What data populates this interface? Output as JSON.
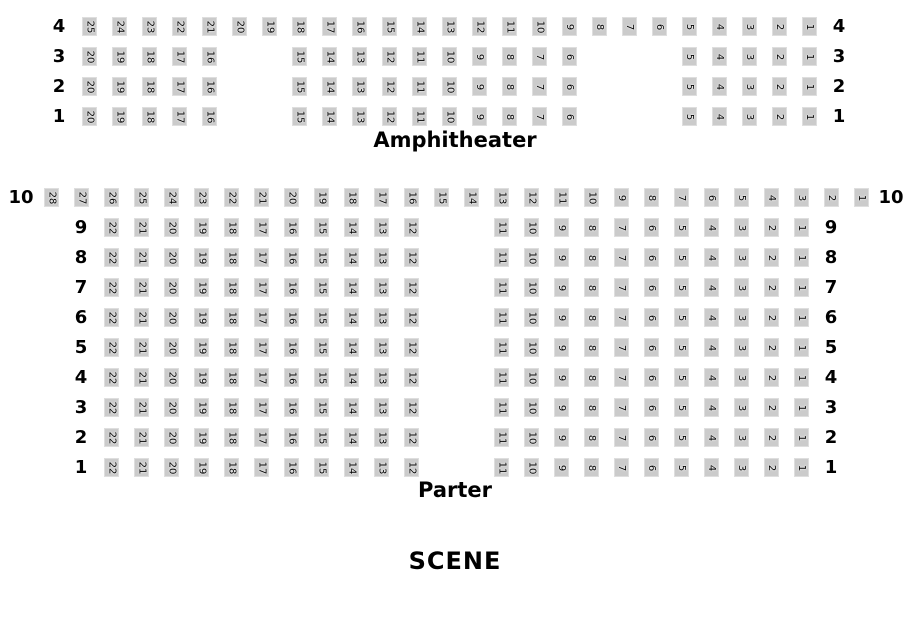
{
  "colors": {
    "background": "#ffffff",
    "seat_bg": "#cbcbcb",
    "seat_edge": "#dedede",
    "text": "#000000"
  },
  "amphitheater": {
    "title": "Amphitheater",
    "rows": [
      {
        "label": "4",
        "cells": [
          "L",
          "25",
          "24",
          "23",
          "22",
          "21",
          "20",
          "19",
          "18",
          "17",
          "16",
          "15",
          "14",
          "13",
          "12",
          "11",
          "10",
          "9",
          "8",
          "7",
          "6",
          "5",
          "4",
          "3",
          "2",
          "1",
          "L"
        ]
      },
      {
        "label": "3",
        "cells": [
          "L",
          "20",
          "19",
          "18",
          "17",
          "16",
          "",
          "",
          "15",
          "14",
          "13",
          "12",
          "11",
          "10",
          "9",
          "8",
          "7",
          "6",
          "",
          "",
          "",
          "5",
          "4",
          "3",
          "2",
          "1",
          "L"
        ]
      },
      {
        "label": "2",
        "cells": [
          "L",
          "20",
          "19",
          "18",
          "17",
          "16",
          "",
          "",
          "15",
          "14",
          "13",
          "12",
          "11",
          "10",
          "9",
          "8",
          "7",
          "6",
          "",
          "",
          "",
          "5",
          "4",
          "3",
          "2",
          "1",
          "L"
        ]
      },
      {
        "label": "1",
        "cells": [
          "L",
          "20",
          "19",
          "18",
          "17",
          "16",
          "",
          "",
          "15",
          "14",
          "13",
          "12",
          "11",
          "10",
          "9",
          "8",
          "7",
          "6",
          "",
          "",
          "",
          "5",
          "4",
          "3",
          "2",
          "1",
          "L"
        ]
      }
    ]
  },
  "parter": {
    "title": "Parter",
    "rows": [
      {
        "label": "10",
        "cells": [
          "L",
          "28",
          "27",
          "26",
          "25",
          "24",
          "23",
          "22",
          "21",
          "20",
          "19",
          "18",
          "17",
          "16",
          "15",
          "14",
          "13",
          "12",
          "11",
          "10",
          "9",
          "8",
          "7",
          "6",
          "5",
          "4",
          "3",
          "2",
          "1",
          "L"
        ]
      },
      {
        "label": "9",
        "cells": [
          "",
          "",
          "L",
          "22",
          "21",
          "20",
          "19",
          "18",
          "17",
          "16",
          "15",
          "14",
          "13",
          "12",
          "",
          "",
          "11",
          "10",
          "9",
          "8",
          "7",
          "6",
          "5",
          "4",
          "3",
          "2",
          "1",
          "L",
          "",
          ""
        ]
      },
      {
        "label": "8",
        "cells": [
          "",
          "",
          "L",
          "22",
          "21",
          "20",
          "19",
          "18",
          "17",
          "16",
          "15",
          "14",
          "13",
          "12",
          "",
          "",
          "11",
          "10",
          "9",
          "8",
          "7",
          "6",
          "5",
          "4",
          "3",
          "2",
          "1",
          "L",
          "",
          ""
        ]
      },
      {
        "label": "7",
        "cells": [
          "",
          "",
          "L",
          "22",
          "21",
          "20",
          "19",
          "18",
          "17",
          "16",
          "15",
          "14",
          "13",
          "12",
          "",
          "",
          "11",
          "10",
          "9",
          "8",
          "7",
          "6",
          "5",
          "4",
          "3",
          "2",
          "1",
          "L",
          "",
          ""
        ]
      },
      {
        "label": "6",
        "cells": [
          "",
          "",
          "L",
          "22",
          "21",
          "20",
          "19",
          "18",
          "17",
          "16",
          "15",
          "14",
          "13",
          "12",
          "",
          "",
          "11",
          "10",
          "9",
          "8",
          "7",
          "6",
          "5",
          "4",
          "3",
          "2",
          "1",
          "L",
          "",
          ""
        ]
      },
      {
        "label": "5",
        "cells": [
          "",
          "",
          "L",
          "22",
          "21",
          "20",
          "19",
          "18",
          "17",
          "16",
          "15",
          "14",
          "13",
          "12",
          "",
          "",
          "11",
          "10",
          "9",
          "8",
          "7",
          "6",
          "5",
          "4",
          "3",
          "2",
          "1",
          "L",
          "",
          ""
        ]
      },
      {
        "label": "4",
        "cells": [
          "",
          "",
          "L",
          "22",
          "21",
          "20",
          "19",
          "18",
          "17",
          "16",
          "15",
          "14",
          "13",
          "12",
          "",
          "",
          "11",
          "10",
          "9",
          "8",
          "7",
          "6",
          "5",
          "4",
          "3",
          "2",
          "1",
          "L",
          "",
          ""
        ]
      },
      {
        "label": "3",
        "cells": [
          "",
          "",
          "L",
          "22",
          "21",
          "20",
          "19",
          "18",
          "17",
          "16",
          "15",
          "14",
          "13",
          "12",
          "",
          "",
          "11",
          "10",
          "9",
          "8",
          "7",
          "6",
          "5",
          "4",
          "3",
          "2",
          "1",
          "L",
          "",
          ""
        ]
      },
      {
        "label": "2",
        "cells": [
          "",
          "",
          "L",
          "22",
          "21",
          "20",
          "19",
          "18",
          "17",
          "16",
          "15",
          "14",
          "13",
          "12",
          "",
          "",
          "11",
          "10",
          "9",
          "8",
          "7",
          "6",
          "5",
          "4",
          "3",
          "2",
          "1",
          "L",
          "",
          ""
        ]
      },
      {
        "label": "1",
        "cells": [
          "",
          "",
          "L",
          "22",
          "21",
          "20",
          "19",
          "18",
          "17",
          "16",
          "15",
          "14",
          "13",
          "12",
          "",
          "",
          "11",
          "10",
          "9",
          "8",
          "7",
          "6",
          "5",
          "4",
          "3",
          "2",
          "1",
          "L",
          "",
          ""
        ]
      }
    ]
  },
  "stage": {
    "label": "SCENE"
  }
}
